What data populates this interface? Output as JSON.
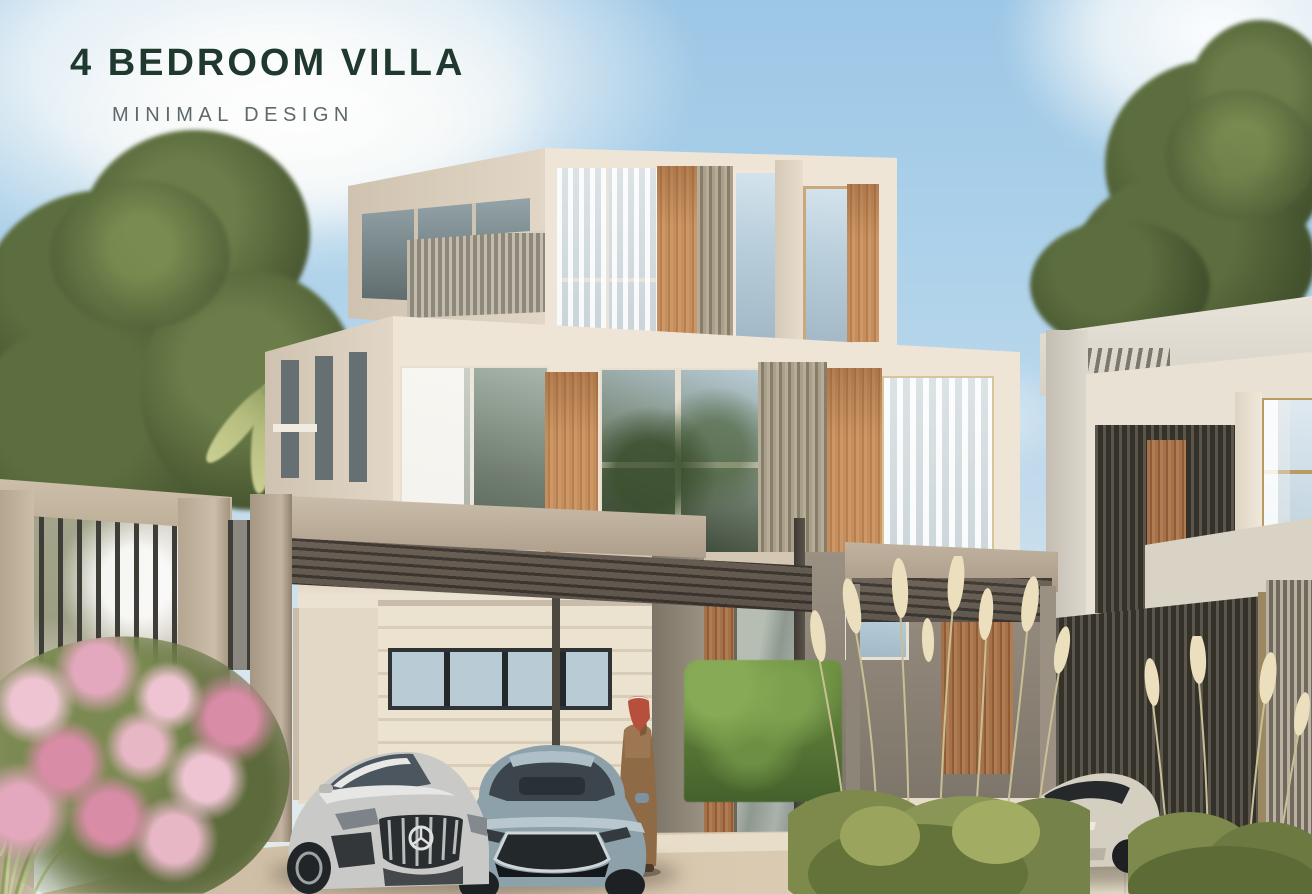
{
  "overlay": {
    "title": "4 BEDROOM VILLA",
    "subtitle": "MINIMAL DESIGN",
    "title_color": "#20392f",
    "subtitle_color": "#5f686a"
  },
  "scene": {
    "type": "architectural_exterior_render",
    "time_of_day": "day",
    "objects": [
      "three-storey minimal villa with cream facade, oak wood panels and louver screens",
      "roof terrace with louver railing",
      "carport pergola with slatted canopy",
      "garage with horizontal slat door and dark clerestory window",
      "entrance portico with man in traditional thobe and ghutra",
      "silver mercedes-amg sedan",
      "grey-blue mazda sedan",
      "silver tesla crossover",
      "neighbouring villa with dark louver screens",
      "green trees and weeping palm",
      "pink flowering shrub",
      "pampas grass and clipped hedges",
      "beige fence with dark metal balusters"
    ],
    "palette": {
      "sky": "#aed2ea",
      "cloud": "#f4f4f1",
      "facade_cream": "#ece3d6",
      "facade_shade": "#d6c9b7",
      "wood_oak": "#c28b5c",
      "louver_grey": "#9a9184",
      "screen_dark": "#3f3b35",
      "pergola_beige": "#b7a996",
      "concrete_grey": "#8a8275",
      "glass_sky": "#c2d5e1",
      "hedge_green": "#5f7a3e",
      "pampas_plume": "#ecdfbe",
      "driveway_tan": "#d5c6ae",
      "flower_pink": "#e5aec1"
    }
  }
}
